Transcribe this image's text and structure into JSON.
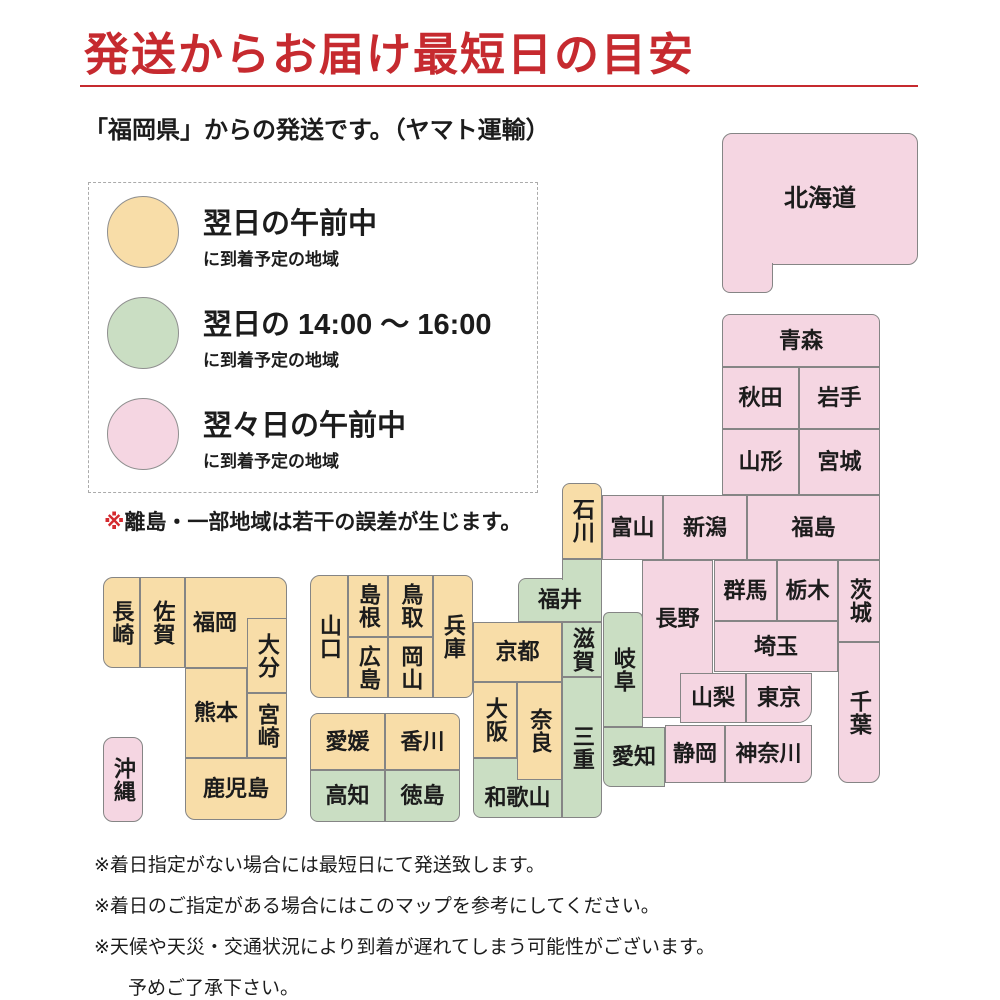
{
  "title": "発送からお届け最短日の目安",
  "subtitle": "「福岡県」からの発送です。（ヤマト運輸）",
  "colors": {
    "next_morning": "#F8DDA8",
    "next_afternoon": "#CADEC3",
    "two_days_morning": "#F5D6E2",
    "block_border": "#858585",
    "title_red": "#C62A2F",
    "note_mark_red": "#D42A2F"
  },
  "legend": {
    "items": [
      {
        "key": "next_morning",
        "label": "翌日の午前中",
        "sub": "に到着予定の地域"
      },
      {
        "key": "next_afternoon",
        "label": "翌日の 14:00 ～ 16:00",
        "sub": "に到着予定の地域"
      },
      {
        "key": "two_days_morning",
        "label": "翌々日の午前中",
        "sub": "に到着予定の地域"
      }
    ]
  },
  "map_note": {
    "marker": "※",
    "text": "離島・一部地域は若干の誤差が生じます。"
  },
  "map": {
    "prefectures": [
      {
        "id": "hokkaido",
        "name": "北海道",
        "x": 722,
        "y": 133,
        "w": 196,
        "h": 132,
        "c": "p",
        "r": "10 10 10 0",
        "fs": 24
      },
      {
        "id": "hokkaido-ext",
        "name": "",
        "x": 722,
        "y": 263,
        "w": 51,
        "h": 30,
        "c": "p",
        "r": "0 0 8 8",
        "noTop": true,
        "z": 3
      },
      {
        "id": "aomori",
        "name": "青森",
        "x": 722,
        "y": 314,
        "w": 158,
        "h": 53,
        "c": "p",
        "r": "8 8 0 0"
      },
      {
        "id": "akita",
        "name": "秋田",
        "x": 722,
        "y": 367,
        "w": 77,
        "h": 62,
        "c": "p"
      },
      {
        "id": "iwate",
        "name": "岩手",
        "x": 799,
        "y": 367,
        "w": 81,
        "h": 62,
        "c": "p"
      },
      {
        "id": "yamagata",
        "name": "山形",
        "x": 722,
        "y": 429,
        "w": 77,
        "h": 66,
        "c": "p"
      },
      {
        "id": "miyagi",
        "name": "宮城",
        "x": 799,
        "y": 429,
        "w": 81,
        "h": 66,
        "c": "p"
      },
      {
        "id": "ishikawa",
        "name": "石川",
        "x": 562,
        "y": 483,
        "w": 40,
        "h": 76,
        "c": "o",
        "v": true,
        "r": "8 8 0 0"
      },
      {
        "id": "toyama",
        "name": "富山",
        "x": 602,
        "y": 495,
        "w": 61,
        "h": 65,
        "c": "p"
      },
      {
        "id": "niigata",
        "name": "新潟",
        "x": 663,
        "y": 495,
        "w": 84,
        "h": 65,
        "c": "p"
      },
      {
        "id": "fukushima",
        "name": "福島",
        "x": 747,
        "y": 495,
        "w": 133,
        "h": 65,
        "c": "p"
      },
      {
        "id": "fukui-ext",
        "name": "",
        "x": 562,
        "y": 559,
        "w": 40,
        "h": 21,
        "c": "g",
        "noBot": true,
        "z": 3
      },
      {
        "id": "fukui",
        "name": "福井",
        "x": 518,
        "y": 578,
        "w": 84,
        "h": 44,
        "c": "g",
        "r": "8 0 0 0"
      },
      {
        "id": "shiga",
        "name": "滋賀",
        "x": 562,
        "y": 622,
        "w": 40,
        "h": 55,
        "c": "g",
        "v": true
      },
      {
        "id": "gifu",
        "name": "岐阜",
        "x": 603,
        "y": 612,
        "w": 40,
        "h": 115,
        "c": "g",
        "v": true,
        "r": "6 6 0 0"
      },
      {
        "id": "mie",
        "name": "三重",
        "x": 562,
        "y": 677,
        "w": 40,
        "h": 141,
        "c": "g",
        "v": true,
        "r": "0 0 8 0"
      },
      {
        "id": "kyoto",
        "name": "京都",
        "x": 473,
        "y": 622,
        "w": 89,
        "h": 60,
        "c": "o"
      },
      {
        "id": "osaka",
        "name": "大阪",
        "x": 473,
        "y": 682,
        "w": 44,
        "h": 76,
        "c": "o",
        "v": true
      },
      {
        "id": "wakayama",
        "name": "和歌山",
        "x": 473,
        "y": 758,
        "w": 89,
        "h": 60,
        "c": "g",
        "r": "0 0 0 8",
        "padT": 20
      },
      {
        "id": "nara",
        "name": "奈良",
        "x": 517,
        "y": 682,
        "w": 45,
        "h": 98,
        "c": "o",
        "v": true,
        "z": 2
      },
      {
        "id": "nagano",
        "name": "長野",
        "x": 642,
        "y": 560,
        "w": 71,
        "h": 158,
        "c": "p",
        "padB": 40
      },
      {
        "id": "gunma",
        "name": "群馬",
        "x": 714,
        "y": 560,
        "w": 63,
        "h": 61,
        "c": "p"
      },
      {
        "id": "tochigi",
        "name": "栃木",
        "x": 777,
        "y": 560,
        "w": 61,
        "h": 61,
        "c": "p"
      },
      {
        "id": "ibaraki",
        "name": "茨城",
        "x": 838,
        "y": 560,
        "w": 42,
        "h": 82,
        "c": "p",
        "v": true
      },
      {
        "id": "saitama",
        "name": "埼玉",
        "x": 714,
        "y": 621,
        "w": 124,
        "h": 51,
        "c": "p"
      },
      {
        "id": "yamanashi",
        "name": "山梨",
        "x": 680,
        "y": 673,
        "w": 66,
        "h": 50,
        "c": "p",
        "z": 2
      },
      {
        "id": "tokyo",
        "name": "東京",
        "x": 746,
        "y": 673,
        "w": 66,
        "h": 50,
        "c": "p",
        "r": "0 0 14 0"
      },
      {
        "id": "chiba",
        "name": "千葉",
        "x": 838,
        "y": 642,
        "w": 42,
        "h": 141,
        "c": "p",
        "v": true,
        "r": "0 0 10 10"
      },
      {
        "id": "shizuoka",
        "name": "静岡",
        "x": 665,
        "y": 725,
        "w": 60,
        "h": 58,
        "c": "p"
      },
      {
        "id": "kanagawa",
        "name": "神奈川",
        "x": 725,
        "y": 725,
        "w": 87,
        "h": 58,
        "c": "p",
        "r": "0 0 10 0"
      },
      {
        "id": "aichi",
        "name": "愛知",
        "x": 603,
        "y": 727,
        "w": 62,
        "h": 60,
        "c": "g",
        "r": "0 0 0 8"
      },
      {
        "id": "yamaguchi",
        "name": "山口",
        "x": 310,
        "y": 575,
        "w": 38,
        "h": 123,
        "c": "o",
        "v": true,
        "r": "10 0 0 10"
      },
      {
        "id": "shimane",
        "name": "島根",
        "x": 348,
        "y": 575,
        "w": 40,
        "h": 62,
        "c": "o",
        "v": true
      },
      {
        "id": "tottori",
        "name": "鳥取",
        "x": 388,
        "y": 575,
        "w": 45,
        "h": 62,
        "c": "o",
        "v": true
      },
      {
        "id": "hiroshima",
        "name": "広島",
        "x": 348,
        "y": 637,
        "w": 40,
        "h": 61,
        "c": "o",
        "v": true
      },
      {
        "id": "okayama",
        "name": "岡山",
        "x": 388,
        "y": 637,
        "w": 45,
        "h": 61,
        "c": "o",
        "v": true
      },
      {
        "id": "hyogo",
        "name": "兵庫",
        "x": 433,
        "y": 575,
        "w": 40,
        "h": 123,
        "c": "o",
        "v": true,
        "r": "0 8 8 0"
      },
      {
        "id": "ehime",
        "name": "愛媛",
        "x": 310,
        "y": 713,
        "w": 75,
        "h": 57,
        "c": "o",
        "r": "8 0 0 0"
      },
      {
        "id": "kagawa",
        "name": "香川",
        "x": 385,
        "y": 713,
        "w": 75,
        "h": 57,
        "c": "o",
        "r": "0 8 0 0"
      },
      {
        "id": "kochi",
        "name": "高知",
        "x": 310,
        "y": 770,
        "w": 75,
        "h": 52,
        "c": "g",
        "r": "0 0 0 8"
      },
      {
        "id": "tokushima",
        "name": "徳島",
        "x": 385,
        "y": 770,
        "w": 75,
        "h": 52,
        "c": "g",
        "r": "0 0 8 0"
      },
      {
        "id": "nagasaki",
        "name": "長崎",
        "x": 103,
        "y": 577,
        "w": 37,
        "h": 91,
        "c": "o",
        "v": true,
        "r": "10 0 0 10"
      },
      {
        "id": "saga",
        "name": "佐賀",
        "x": 140,
        "y": 577,
        "w": 45,
        "h": 91,
        "c": "o",
        "v": true
      },
      {
        "id": "fukuoka",
        "name": "福岡",
        "x": 185,
        "y": 577,
        "w": 102,
        "h": 91,
        "c": "o",
        "r": "0 10 0 0",
        "padR": 42
      },
      {
        "id": "oita",
        "name": "大分",
        "x": 247,
        "y": 618,
        "w": 40,
        "h": 75,
        "c": "o",
        "v": true,
        "z": 2
      },
      {
        "id": "kumamoto",
        "name": "熊本",
        "x": 185,
        "y": 668,
        "w": 62,
        "h": 90,
        "c": "o"
      },
      {
        "id": "miyazaki",
        "name": "宮崎",
        "x": 247,
        "y": 693,
        "w": 40,
        "h": 65,
        "c": "o",
        "v": true
      },
      {
        "id": "kagoshima",
        "name": "鹿児島",
        "x": 185,
        "y": 758,
        "w": 102,
        "h": 62,
        "c": "o",
        "r": "0 0 10 10"
      },
      {
        "id": "okinawa",
        "name": "沖縄",
        "x": 103,
        "y": 737,
        "w": 40,
        "h": 85,
        "c": "p",
        "v": true,
        "r": "10 10 10 10"
      }
    ]
  },
  "footnotes": [
    "※着日指定がない場合には最短日にて発送致します。",
    "※着日のご指定がある場合にはこのマップを参考にしてください。",
    "※天候や天災・交通状況により到着が遅れてしまう可能性がございます。",
    "予めご了承下さい。"
  ]
}
